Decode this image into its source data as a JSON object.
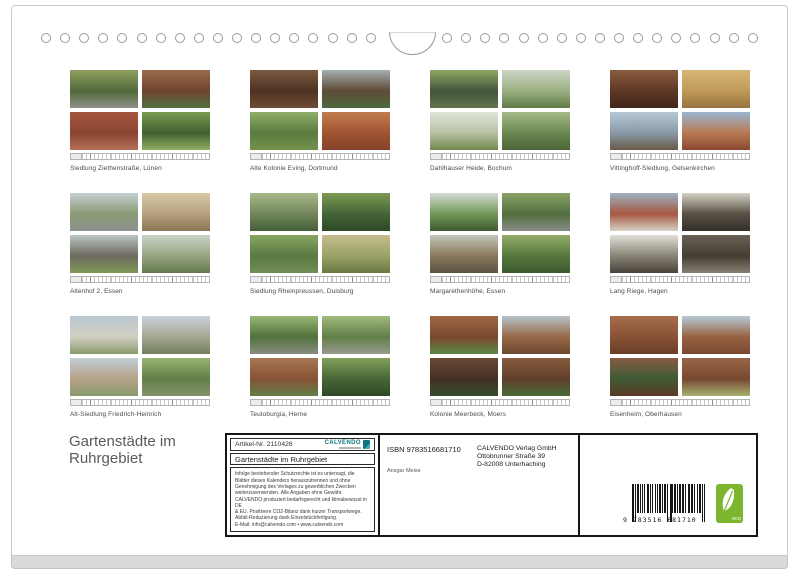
{
  "page": {
    "title": "Gartenstädte im\nRuhrgebiet"
  },
  "thumbnails": [
    {
      "caption": "Siedlung Ziethenstraße, Lünen",
      "photos": [
        [
          "#8fa05e",
          "#52693b",
          "#8e9089"
        ],
        [
          "#9a6b4a",
          "#6e4430",
          "#54713f"
        ],
        [
          "#a65640",
          "#8a4431",
          "#b5715a"
        ],
        [
          "#7a9a52",
          "#42602f",
          "#8fae66"
        ]
      ]
    },
    {
      "caption": "Alte Kolonie Eving, Dortmund",
      "photos": [
        [
          "#7a5a40",
          "#4e3223",
          "#6e4c34"
        ],
        [
          "#a4b0b0",
          "#5e4a36",
          "#4c6c3c"
        ],
        [
          "#90ae68",
          "#5a7a40",
          "#74924c"
        ],
        [
          "#c27c4c",
          "#a05432",
          "#86422a"
        ]
      ]
    },
    {
      "caption": "Dahlhauser Heide, Bochum",
      "photos": [
        [
          "#90a864",
          "#44543a",
          "#60744a"
        ],
        [
          "#ccd6c8",
          "#9cb082",
          "#5e7a46"
        ],
        [
          "#e0e4da",
          "#b6c2a4",
          "#72884e"
        ],
        [
          "#a6ba88",
          "#6a8850",
          "#4a6436"
        ]
      ]
    },
    {
      "caption": "Vittinghoff-Siedlung, Gelsenkirchen",
      "photos": [
        [
          "#8a5c3e",
          "#5e3826",
          "#412619"
        ],
        [
          "#d6b678",
          "#c09a58",
          "#967240"
        ],
        [
          "#b6c8d6",
          "#8898a6",
          "#6a5a48"
        ],
        [
          "#9ab6d2",
          "#b87a52",
          "#8a4830"
        ]
      ]
    },
    {
      "caption": "Altenhof 2, Essen",
      "photos": [
        [
          "#c6d0d6",
          "#8a9a74",
          "#8e9290"
        ],
        [
          "#d8c8a6",
          "#b6a27e",
          "#8a7452"
        ],
        [
          "#bac6c2",
          "#6e6a5e",
          "#7e9a56"
        ],
        [
          "#cad2c6",
          "#98a682",
          "#64784a"
        ]
      ]
    },
    {
      "caption": "Siedlung Rheinpreussen, Duisburg",
      "photos": [
        [
          "#a6ba88",
          "#72865a",
          "#445e38"
        ],
        [
          "#7c9a52",
          "#446438",
          "#2e4826"
        ],
        [
          "#88a660",
          "#5a7842",
          "#728e58"
        ],
        [
          "#c8bc90",
          "#98a266",
          "#6a7842"
        ]
      ]
    },
    {
      "caption": "Margarethenhöhe, Essen",
      "photos": [
        [
          "#d2dad2",
          "#729858",
          "#3e5a34"
        ],
        [
          "#88a266",
          "#526e3e",
          "#888c86"
        ],
        [
          "#c2c8ba",
          "#88785c",
          "#5c5242"
        ],
        [
          "#92ac66",
          "#56783e",
          "#3a5a2e"
        ]
      ]
    },
    {
      "caption": "Lang Riege, Hagen",
      "photos": [
        [
          "#9cb2c2",
          "#a65840",
          "#d6d2c6"
        ],
        [
          "#d6d2c6",
          "#585146",
          "#342f29"
        ],
        [
          "#e2e0d8",
          "#888376",
          "#48423a"
        ],
        [
          "#6a6153",
          "#443d33",
          "#888072"
        ]
      ]
    },
    {
      "caption": "Alt-Siedlung Friedrich-Heinrich",
      "photos": [
        [
          "#bac8d2",
          "#d2cec2",
          "#889a6c"
        ],
        [
          "#c8d2d8",
          "#a6a692",
          "#72805a"
        ],
        [
          "#c2ced8",
          "#b6a288",
          "#889a6e"
        ],
        [
          "#98b272",
          "#617f48",
          "#88926a"
        ]
      ]
    },
    {
      "caption": "Teutoburgia, Herne",
      "photos": [
        [
          "#98b672",
          "#52723e",
          "#888c82"
        ],
        [
          "#a2ba7e",
          "#617f48",
          "#989a8e"
        ],
        [
          "#a67852",
          "#885236",
          "#617f48"
        ],
        [
          "#82a05a",
          "#486636",
          "#2e4826"
        ]
      ]
    },
    {
      "caption": "Kolonie Meerbeck, Moers",
      "photos": [
        [
          "#9e6846",
          "#7a482e",
          "#5c8844"
        ],
        [
          "#b6c2ca",
          "#986846",
          "#6c4832"
        ],
        [
          "#6a4834",
          "#452f23",
          "#344e2b"
        ],
        [
          "#885c3e",
          "#613f2b",
          "#486a36"
        ]
      ]
    },
    {
      "caption": "Eisenheim, Oberhausen",
      "photos": [
        [
          "#a66e4e",
          "#885236",
          "#6a3e27"
        ],
        [
          "#b6cad6",
          "#986242",
          "#784830"
        ],
        [
          "#885c42",
          "#3e5a34",
          "#5c3927"
        ],
        [
          "#986646",
          "#784830",
          "#a6b272"
        ]
      ]
    }
  ],
  "info_box": {
    "article_label": "Artikel-Nr. 2110426",
    "logo_text": "CALVENDO",
    "product_title": "Gartenstädte im Ruhrgebiet",
    "legal_text": "Infolge bestehender Schutzrechte ist es untersagt, die\nBlätter dieses Kalenders herauszutrennen und ohne\nGenehmigung des Verlages zu gewerblichen Zwecken\nweiterzuverwenden. Alle Angaben ohne Gewähr.\nCALVENDO produziert bedarfsgerecht und klimabewusst in DE\n& EU. Positivere CO2-Bilanz dank kurzer Transportwege.\nAbfall-Reduzierung dank Einzelstückfertigung.\nE-Mail: info@calvendo.com • www.calvendo.com",
    "isbn": "ISBN 9783516681710",
    "publisher": "CALVENDO Verlag GmbH\nOttobrunner Straße 39\nD-82008 Unterhaching",
    "author": "Ansgar Meise",
    "barcode_digits": "9 783516 681710",
    "eco_label": "eco",
    "colors": {
      "calvendo_teal": "#0c7680",
      "eco_green": "#7cb52e"
    }
  }
}
